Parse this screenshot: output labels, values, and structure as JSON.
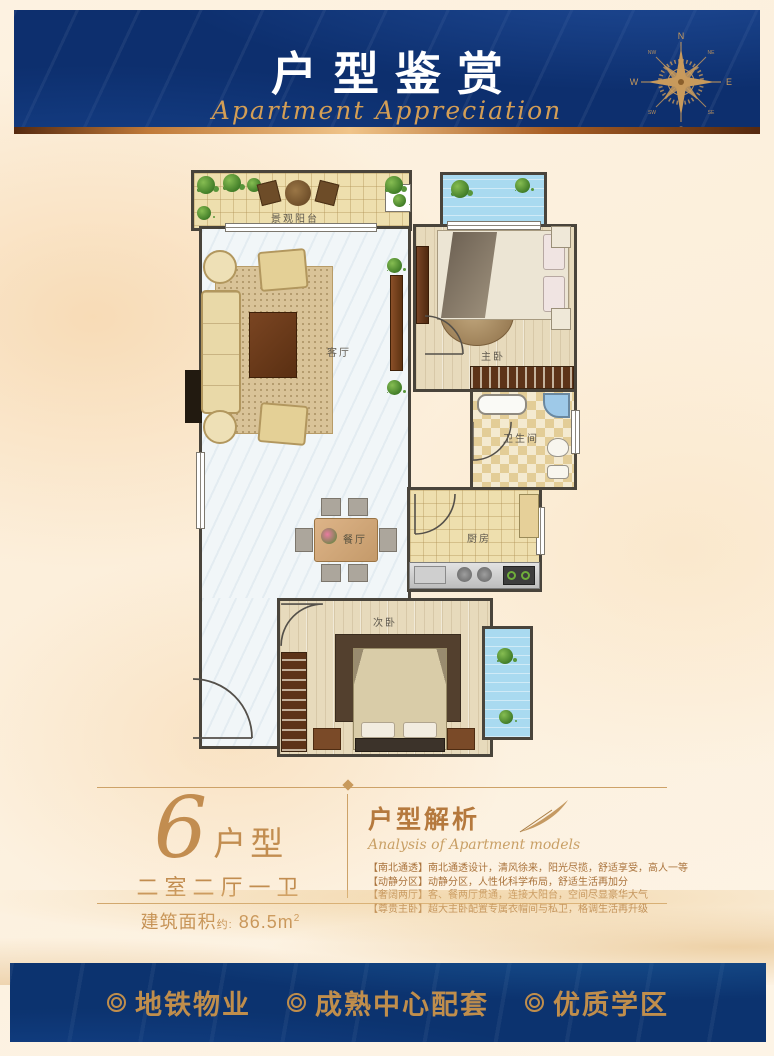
{
  "header": {
    "title": "户型鉴赏",
    "subtitle": "Apartment Appreciation",
    "compass": {
      "n": "N",
      "e": "E",
      "s": "S",
      "w": "W",
      "nw": "NW",
      "ne": "NE",
      "sw": "SW",
      "se": "SE"
    }
  },
  "floorplan": {
    "rooms": {
      "balcony": "景观阳台",
      "living": "客厅",
      "master": "主卧",
      "bath": "卫生间",
      "kitchen": "厨房",
      "dining": "餐厅",
      "second": "次卧"
    }
  },
  "info": {
    "unit_number": "6",
    "unit_suffix": "户型",
    "layout": "二室二厅一卫",
    "area_label": "建筑面积",
    "area_note": "约:",
    "area_value": "86.5m",
    "area_sup": "2"
  },
  "analysis": {
    "title": "户型解析",
    "subtitle": "Analysis of Apartment models",
    "bullets": [
      "【南北通透】南北通透设计，清风徐来，阳光尽揽，舒适享受，高人一等",
      "【动静分区】动静分区，人性化科学布局，舒适生活再加分",
      "【奢阔两厅】客、餐两厅贯通，连接大阳台，空间尽显豪华大气",
      "【尊贵主卧】超大主卧配置专属衣帽间与私卫，格调生活再升级"
    ]
  },
  "footer": {
    "items": [
      "地铁物业",
      "成熟中心配套",
      "优质学区"
    ]
  },
  "colors": {
    "banner_blue": "#0d2f6e",
    "gold": "#c89a5c",
    "text_gold": "#aa733c",
    "footer_gold": "#c08e4c"
  }
}
